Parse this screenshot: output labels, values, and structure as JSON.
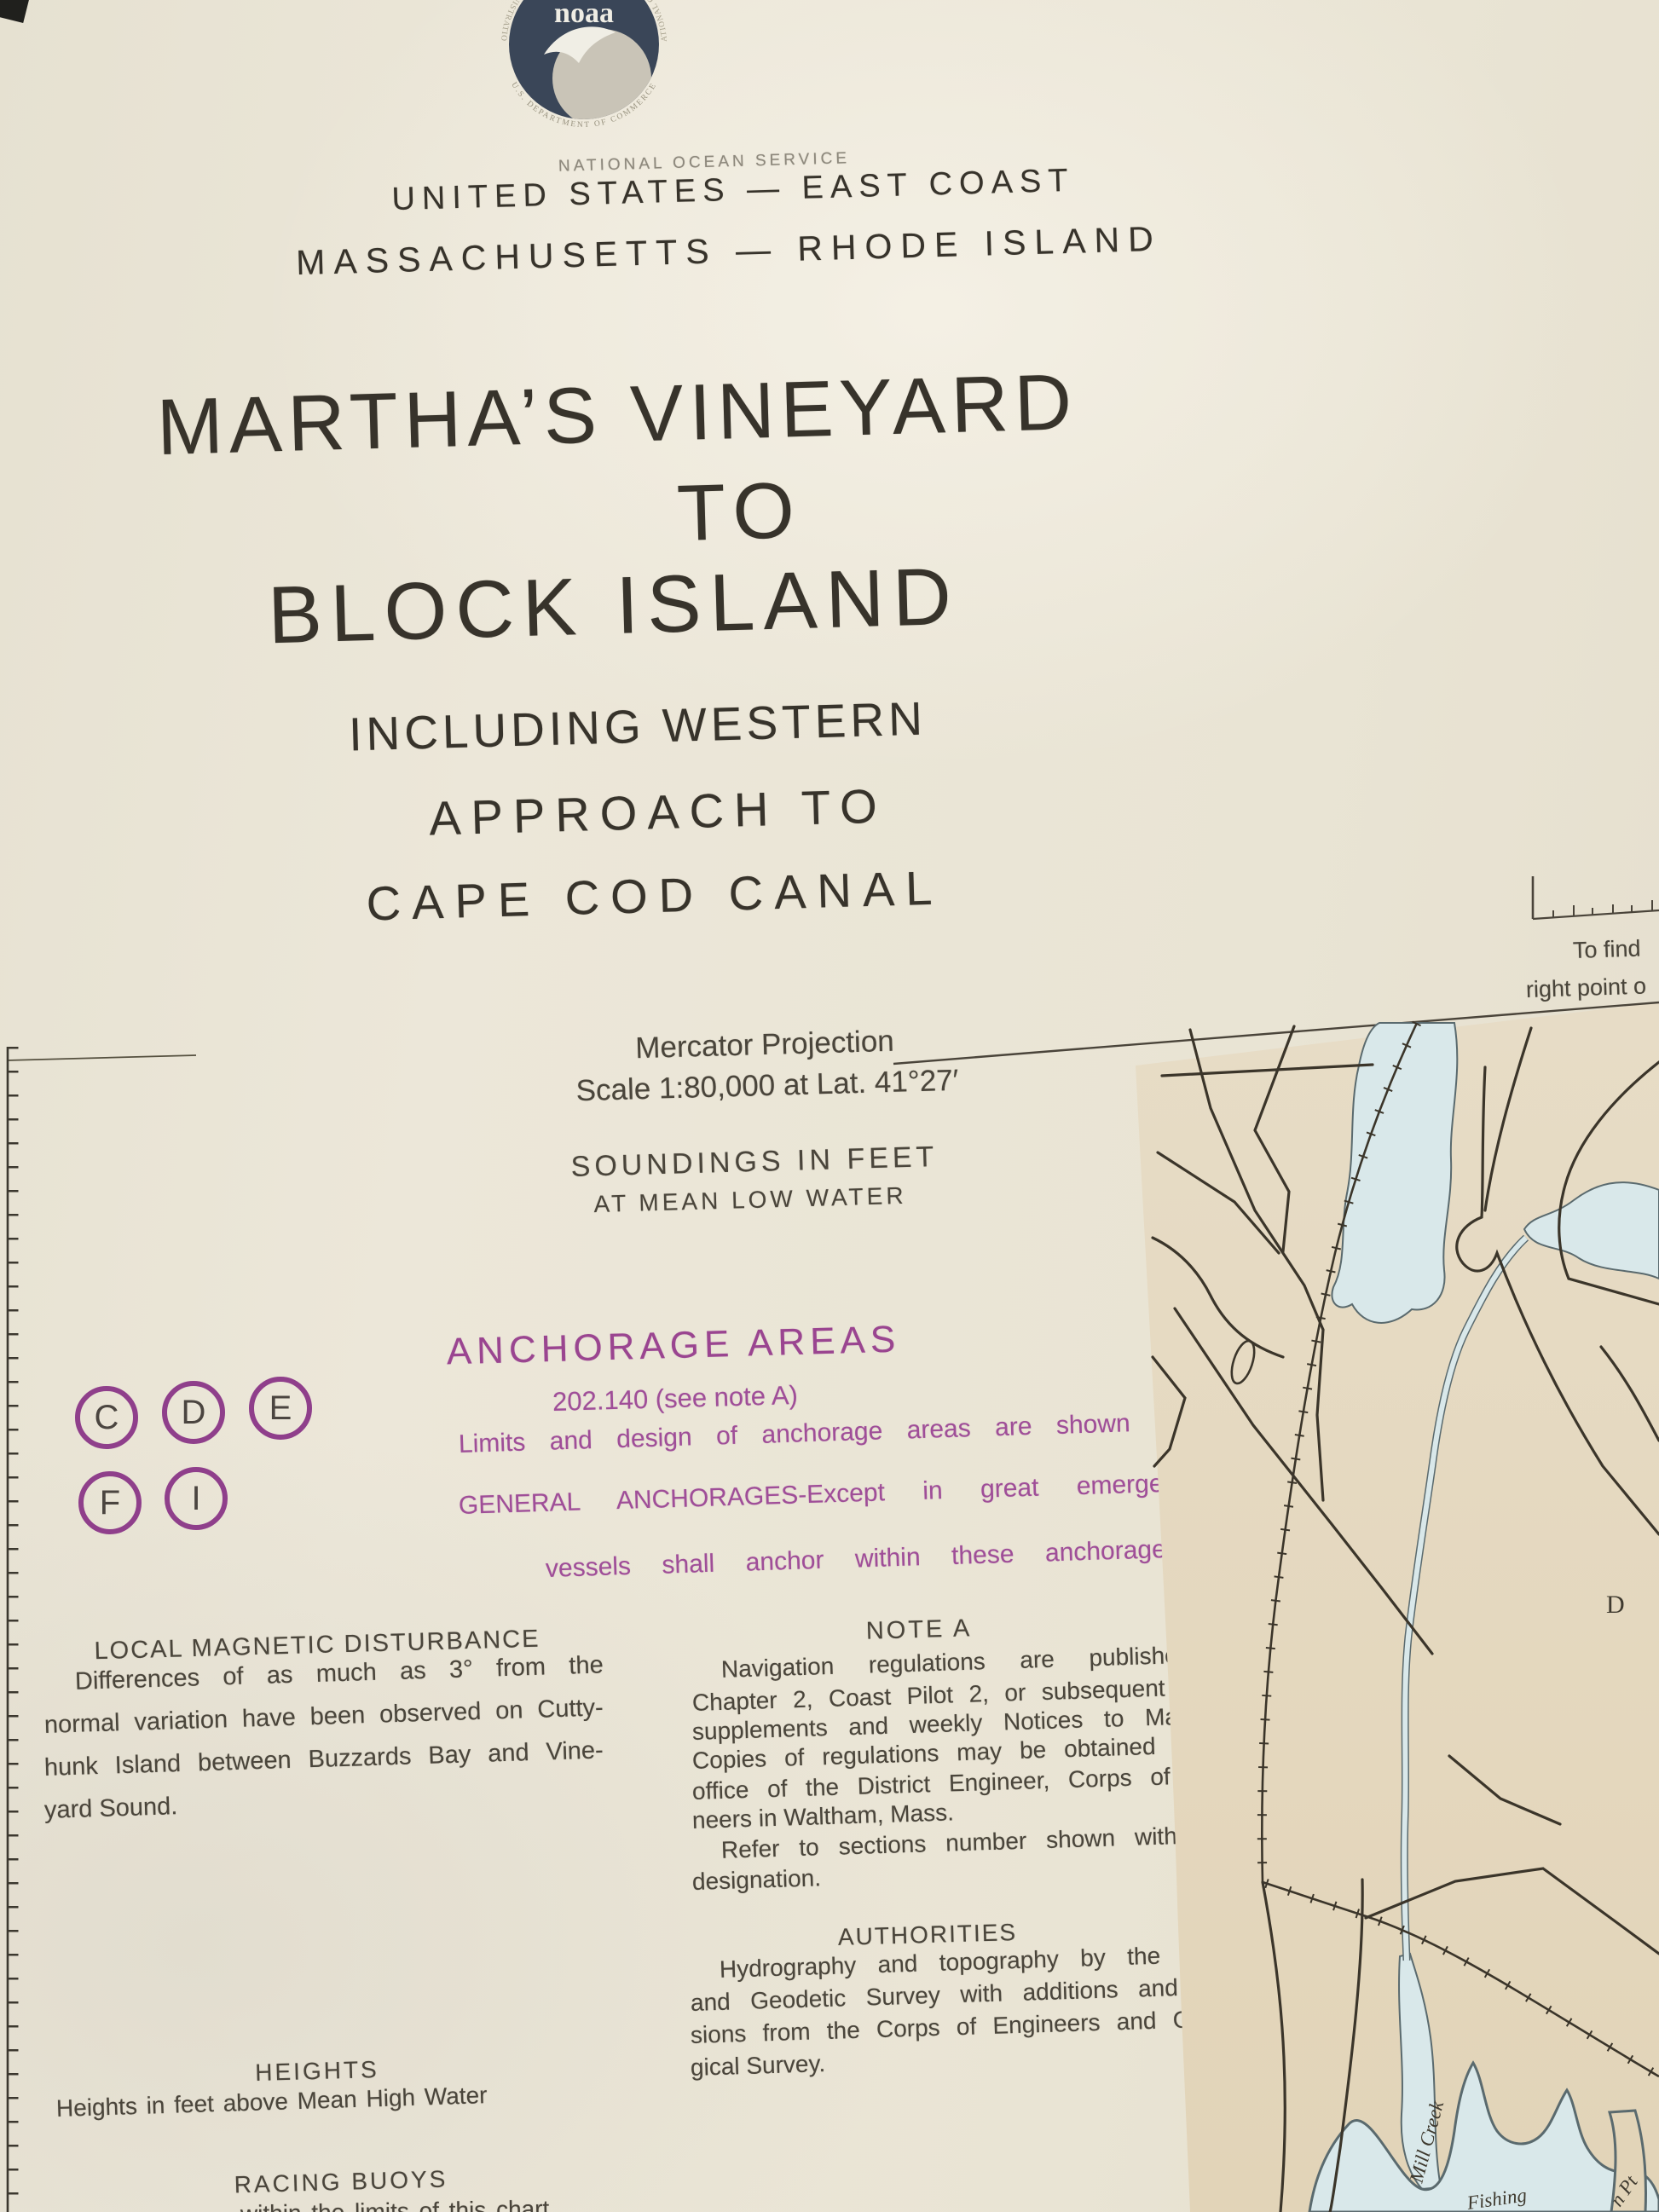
{
  "agency": {
    "logo_text": "noaa",
    "logo_ring_top": "NATIONAL OCEANIC AND ATMOSPHERIC ADMINISTRATION",
    "logo_ring_bottom": "U.S. DEPARTMENT OF COMMERCE",
    "service_line": "NATIONAL OCEAN SERVICE"
  },
  "header": {
    "region_line": "UNITED STATES — EAST COAST",
    "states_line": "MASSACHUSETTS — RHODE ISLAND"
  },
  "title": {
    "line1": "MARTHA’S VINEYARD",
    "line2": "TO",
    "line3": "BLOCK ISLAND",
    "subtitle_line1": "INCLUDING WESTERN",
    "subtitle_line2": "APPROACH TO",
    "subtitle_line3": "CAPE COD CANAL"
  },
  "projection": {
    "line1": "Mercator Projection",
    "line2": "Scale 1:80,000 at Lat. 41°27′"
  },
  "soundings": {
    "line1": "SOUNDINGS IN FEET",
    "line2": "AT MEAN LOW WATER"
  },
  "anchorage": {
    "heading": "ANCHORAGE AREAS",
    "regulation": "202.140 (see note A)",
    "body_line1": "Limits and design of anchorage areas are shown in color.",
    "body_line2": "GENERAL ANCHORAGES-Except in great emergency all",
    "body_line3": "vessels shall anchor within these anchorage areas.",
    "designators": [
      "C",
      "D",
      "E",
      "F",
      "I"
    ],
    "accent_color": "#8f3f8b"
  },
  "magnetic": {
    "heading": "LOCAL MAGNETIC DISTURBANCE",
    "lines": [
      "Differences of as much as 3° from the",
      "normal variation have been observed on Cutty-",
      "hunk Island between Buzzards Bay and Vine-",
      "yard Sound."
    ]
  },
  "note_a": {
    "heading": "NOTE A",
    "lines": [
      "Navigation regulations are published in",
      "Chapter 2, Coast Pilot 2, or subsequent yearly",
      "supplements and weekly Notices to Mariners.",
      "Copies of regulations may be obtained at the",
      "office of the District Engineer, Corps of Engi-",
      "neers in Waltham, Mass.",
      "Refer to sections number shown with area",
      "designation."
    ]
  },
  "authorities": {
    "heading": "AUTHORITIES",
    "lines": [
      "Hydrography and topography by the Coast",
      "and Geodetic Survey with additions and revi-",
      "sions from the Corps of Engineers and Geolo-",
      "gical Survey."
    ]
  },
  "heights": {
    "heading": "HEIGHTS",
    "body": "Heights in feet above Mean High Water"
  },
  "racing_buoys": {
    "heading": "RACING BUOYS",
    "partial_line": "within the limits of this chart"
  },
  "corner_note": {
    "line1": "To find",
    "line2": "right point o"
  },
  "map": {
    "land_color": "#e5d9c0",
    "water_color": "#d9e8ea",
    "labels": {
      "mill_creek": "Mill Creek",
      "fishing": "Fishing",
      "point_fragment": "n Pt",
      "letter_fragment": "D"
    }
  }
}
